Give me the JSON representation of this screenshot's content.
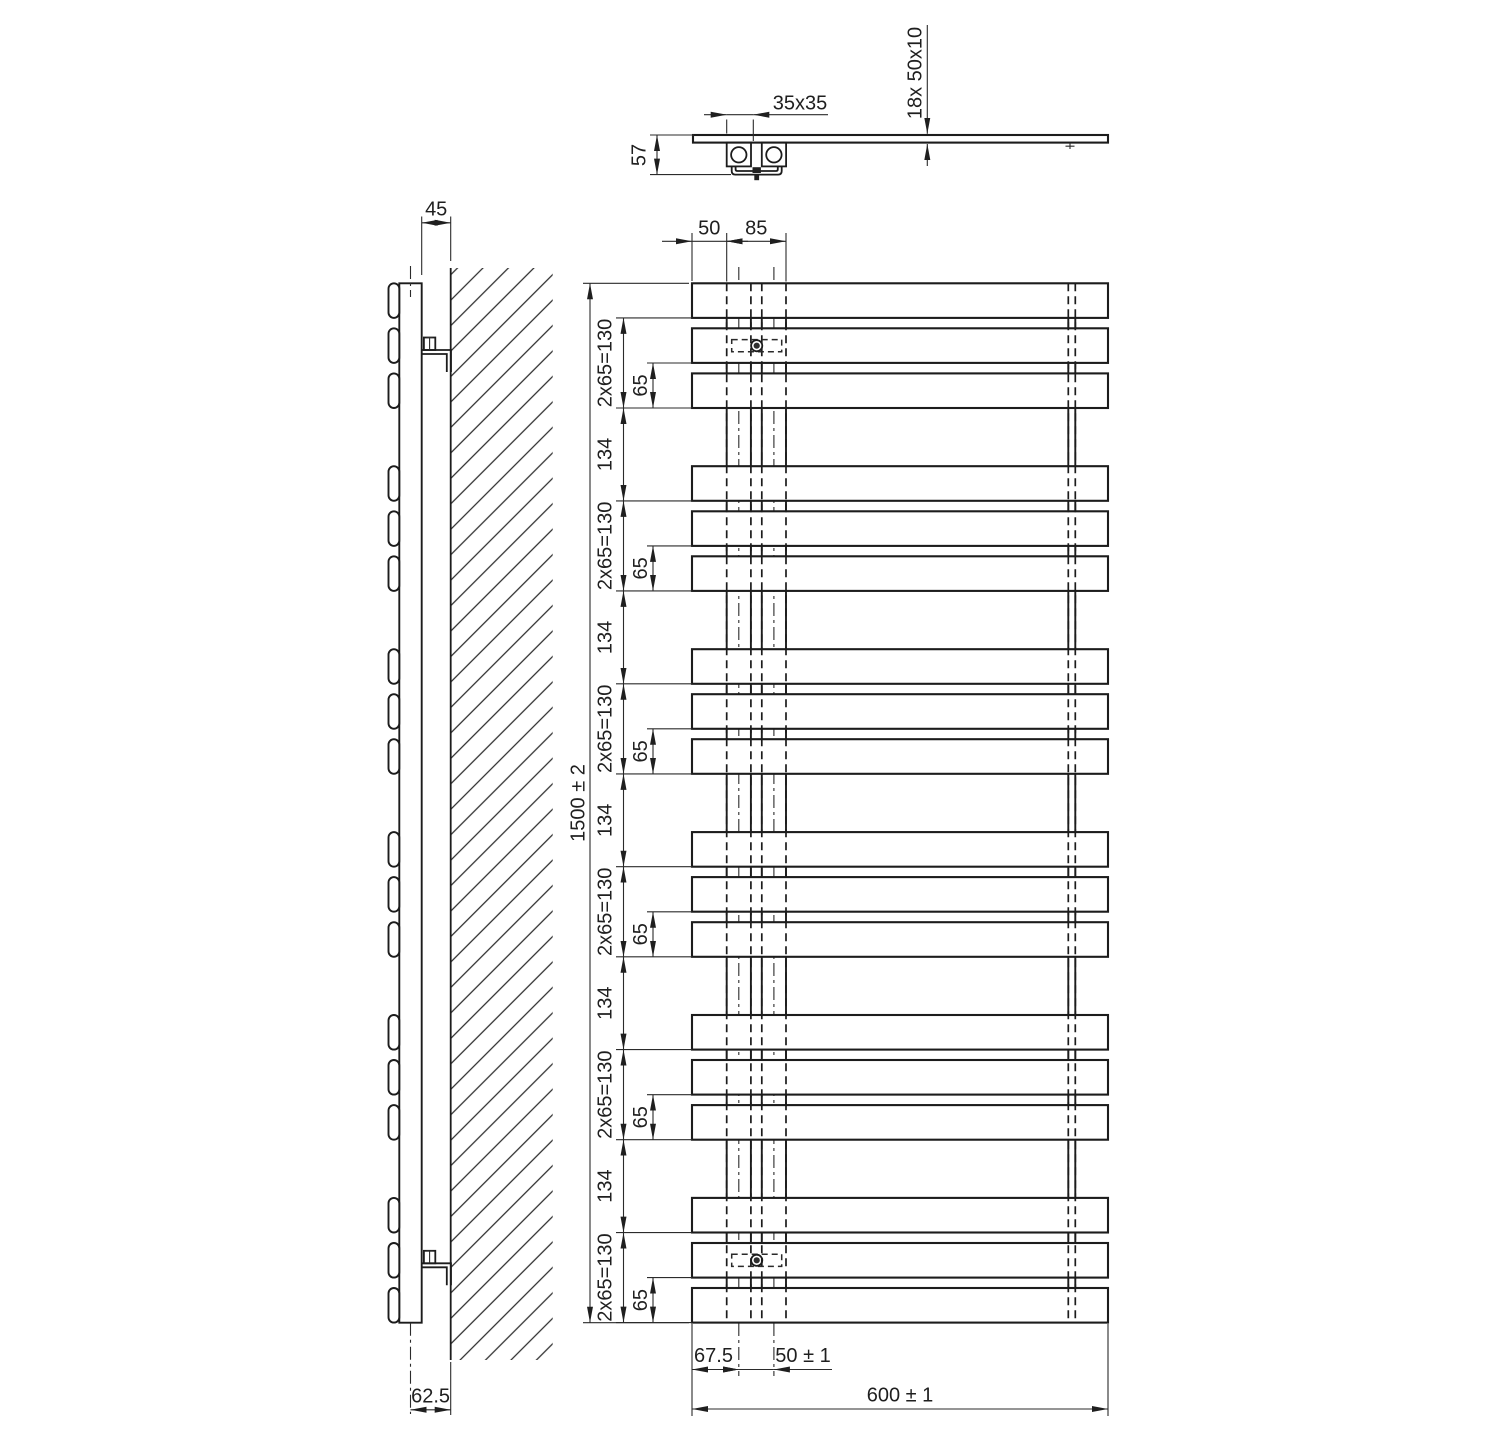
{
  "title": "Towel radiator technical drawing",
  "spec": {
    "height_mm": 1500,
    "width_mm": 600,
    "bar_count": 18,
    "bars_per_group": 3,
    "group_count": 6,
    "bar_height_mm": 50,
    "bar_pitch_mm": 65,
    "group_pitch_mm": 264,
    "bar_section_mm": "50x10",
    "tube_section_mm": "35x35"
  },
  "labels": {
    "top_view": {
      "bar_count_section": "18x  50x10",
      "tube_size": "35x35",
      "bracket_height": "57"
    },
    "side_view": {
      "tube_wall_gap": "45",
      "axis_wall_offset": "62.5"
    },
    "front_view": {
      "edge_to_tube": "50",
      "tube_zone": "85",
      "total_height": "1500 ± 2",
      "group_span": "2x65=130",
      "bar_pitch": "65",
      "group_gap": "134",
      "edge_to_axis": "67.5",
      "axis_spacing": "50 ± 1",
      "total_width": "600 ± 1"
    }
  }
}
